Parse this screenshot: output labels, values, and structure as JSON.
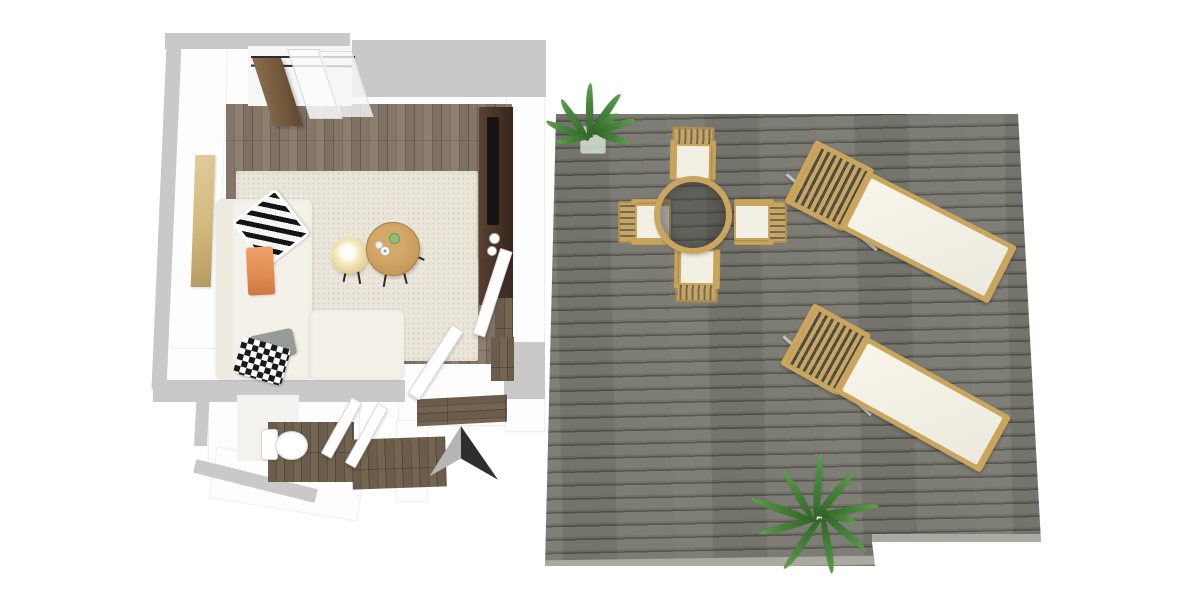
{
  "meta": {
    "scene": "3d-floor-plan-top-down-render",
    "canvas": {
      "width": 1200,
      "height": 600
    },
    "visible_text": "none"
  },
  "palette": {
    "background": "#ffffff",
    "wall_outline": "#c9c9c9",
    "wall_face": "#fdfdfd",
    "rug": "#eae6da",
    "sofa": "#f4f1e8",
    "pillow_gray": "#979c99",
    "throw_orange": "#e08b52",
    "art": "#d1b97e",
    "console_wood": "#4a3426",
    "tv": "#141414",
    "deck_board": "#7a7972",
    "deck_seam": "#53524b",
    "deck_edge": "#aba9a1",
    "outdoor_wood": "#c9a55e",
    "cushion": "#f2efe4",
    "glass_table": "rgba(60,60,56,0.42)",
    "plant_green": "#47833a",
    "arrow_light": "#b5b5b5",
    "arrow_dark": "#2e2e2e",
    "toilet": "#ffffff"
  },
  "floorplan": {
    "rooms": [
      {
        "id": "living-room",
        "floor": "wood planks with cream rug",
        "furniture": [
          "l-shaped-sectional-sofa",
          "zebra-pillow",
          "gingham-pillow",
          "gray-pillow",
          "orange-throw",
          "cream-round-side-table",
          "wood-round-coffee-table",
          "media-console",
          "tv",
          "wall-art",
          "sliding-window",
          "open-wood-door"
        ]
      },
      {
        "id": "bathroom",
        "floor": "dark wood",
        "furniture": [
          "toilet",
          "open-door"
        ]
      },
      {
        "id": "hallway",
        "floor": "dark wood",
        "furniture": [
          "open-door",
          "open-door"
        ]
      },
      {
        "id": "deck",
        "floor": "gray wood boards",
        "furniture": [
          "round-glass-dining-table",
          "outdoor-chair-north",
          "outdoor-chair-west",
          "outdoor-chair-east",
          "outdoor-chair-south",
          "sun-lounger-upper",
          "sun-lounger-lower",
          "potted-plant-top",
          "potted-plant-bottom"
        ]
      }
    ],
    "annotations": [
      {
        "id": "north-arrow",
        "style": "two-tone gray/black arrowhead"
      }
    ]
  }
}
